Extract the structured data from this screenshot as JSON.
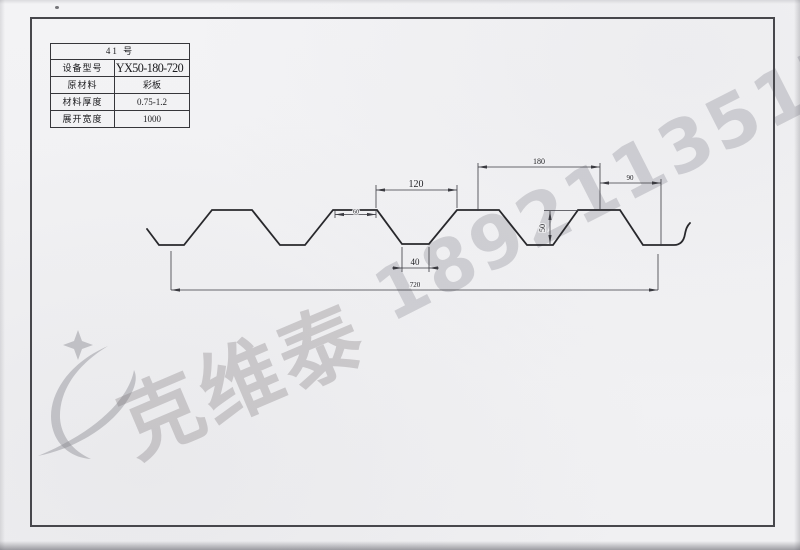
{
  "spec_table": {
    "title": "41 号",
    "rows": [
      {
        "label": "设备型号",
        "value": "YX50-180-720"
      },
      {
        "label": "原材料",
        "value": "彩板"
      },
      {
        "label": "材料厚度",
        "value": "0.75-1.2"
      },
      {
        "label": "展开宽度",
        "value": "1000"
      }
    ]
  },
  "drawing": {
    "dims": {
      "opening_top": "120",
      "crest_flat": "60",
      "valley_bottom": "40",
      "pitch": "180",
      "end_segment": "90",
      "height": "50",
      "coverage": "720"
    }
  },
  "watermark": {
    "company": "克维泰",
    "phone": "18921135170",
    "logo_icon": "swoosh-star-logo"
  },
  "colors": {
    "paper": "#f2f2f4",
    "profile_line": "#28282c",
    "dim_line": "#3a3a40",
    "frame": "#47474c",
    "watermark_gray": "rgba(120,117,118,0.30)"
  }
}
